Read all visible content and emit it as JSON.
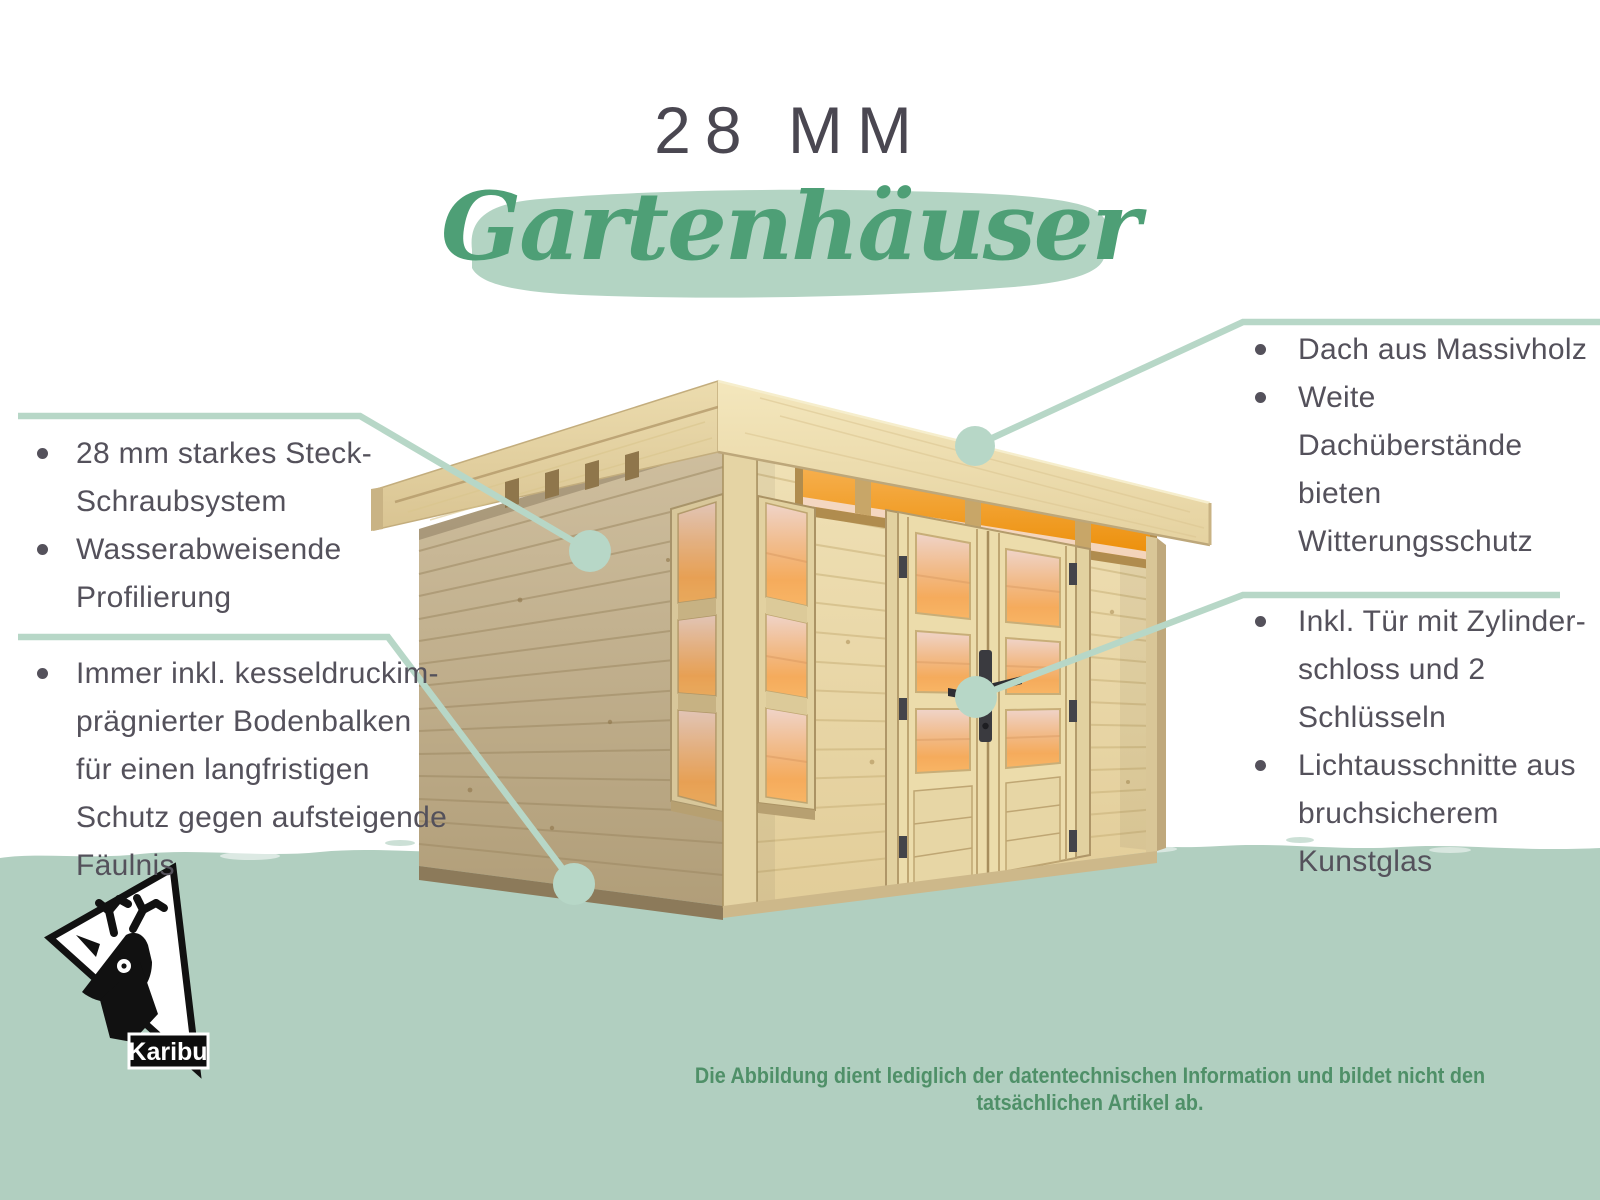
{
  "title": {
    "heading": "28 MM",
    "script": "Gartenhäuser"
  },
  "annotations": {
    "left_top": {
      "items": [
        "28 mm starkes Steck-\nSchraubsystem",
        "Wasserabweisende\nProfilierung"
      ]
    },
    "left_bottom": {
      "items": [
        "Immer inkl. kesseldruckim-\nprägnierter Bodenbalken\nfür einen langfristigen\nSchutz gegen aufsteigende\nFäulnis"
      ]
    },
    "right_top": {
      "items": [
        "Dach aus Massivholz",
        "Weite Dachüberstände\nbieten Witterungsschutz"
      ]
    },
    "right_bottom": {
      "items": [
        "Inkl. Tür mit Zylinder-\nschloss und 2 Schlüsseln",
        "Lichtausschnitte aus\nbruchsicherem Kunstglas"
      ]
    }
  },
  "footer": {
    "disclaimer": "Die Abbildung dient lediglich der datentechnischen Information und bildet nicht den tatsächlichen Artikel ab."
  },
  "logo": {
    "brand": "Karibu"
  },
  "colors": {
    "title_text": "#4a4751",
    "script_green": "#4e9f76",
    "brush_mint": "#b3d4c3",
    "callout_line_mint": "#b7d7c7",
    "band_mint": "#b1cfc0",
    "body_text": "#54515b",
    "disclaimer_green": "#4f9068",
    "wood_front": "#ead9a9",
    "wood_side": "#c4b290",
    "window_glow_orange": "#ee9512"
  }
}
